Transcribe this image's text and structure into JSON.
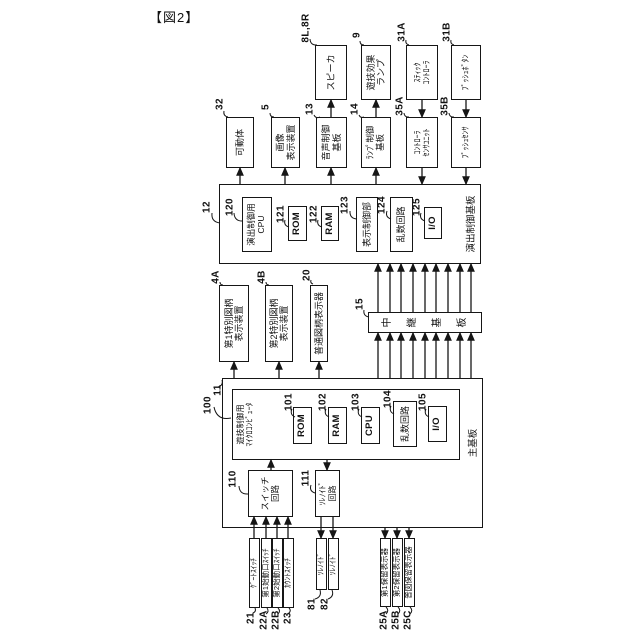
{
  "figure_label": "【図2】",
  "colors": {
    "line": "#161616",
    "background": "#ffffff"
  },
  "diagram": {
    "boxes": [
      {
        "name": "speaker",
        "x": 540,
        "y": 315,
        "w": 55,
        "h": 32,
        "lines": [
          "スピーカ"
        ]
      },
      {
        "name": "game-effect-lamp",
        "x": 540,
        "y": 361,
        "w": 55,
        "h": 30,
        "lines": [
          "遊技効果",
          "ランプ"
        ]
      },
      {
        "name": "stick-controller",
        "x": 540,
        "y": 406,
        "w": 55,
        "h": 32,
        "lines": [
          "ｽﾃｨｯｸ",
          "ｺﾝﾄﾛｰﾗ"
        ],
        "fs": 8
      },
      {
        "name": "push-button",
        "x": 540,
        "y": 451,
        "w": 55,
        "h": 30,
        "lines": [
          "ﾌﾟｯｼｭﾎﾞﾀﾝ"
        ],
        "fs": 8
      },
      {
        "name": "movable-body",
        "x": 472,
        "y": 226,
        "w": 51,
        "h": 28,
        "lines": [
          "可動体"
        ]
      },
      {
        "name": "image-display-device",
        "x": 472,
        "y": 271,
        "w": 51,
        "h": 29,
        "lines": [
          "画像",
          "表示装置"
        ]
      },
      {
        "name": "audio-control-board",
        "x": 472,
        "y": 316,
        "w": 51,
        "h": 31,
        "lines": [
          "音声制御",
          "基板"
        ]
      },
      {
        "name": "lamp-control-board",
        "x": 472,
        "y": 361,
        "w": 51,
        "h": 30,
        "lines": [
          "ﾗﾝﾌﾟ制御",
          "基板"
        ],
        "fs": 8.5
      },
      {
        "name": "controller-sensor-unit",
        "x": 472,
        "y": 406,
        "w": 51,
        "h": 32,
        "lines": [
          "ｺﾝﾄﾛｰﾗ",
          "ｾﾝｻﾕﾆｯﾄ"
        ],
        "fs": 8
      },
      {
        "name": "push-sensor",
        "x": 472,
        "y": 451,
        "w": 51,
        "h": 30,
        "lines": [
          "ﾌﾟｯｼｭｾﾝｻ"
        ],
        "fs": 8
      },
      {
        "name": "effect-control-board",
        "x": 376,
        "y": 219,
        "w": 80,
        "h": 262,
        "lines": [],
        "frame": true
      },
      {
        "name": "effect-cpu",
        "x": 388,
        "y": 242,
        "w": 55,
        "h": 30,
        "lines": [
          "演出制御用",
          "CPU"
        ],
        "fs": 8.5
      },
      {
        "name": "effect-rom",
        "x": 399,
        "y": 288,
        "w": 35,
        "h": 19,
        "lines": [
          "ROM"
        ],
        "bold": true
      },
      {
        "name": "effect-ram",
        "x": 399,
        "y": 321,
        "w": 35,
        "h": 18,
        "lines": [
          "RAM"
        ],
        "bold": true
      },
      {
        "name": "display-control-unit",
        "x": 388,
        "y": 356,
        "w": 55,
        "h": 22,
        "lines": [
          "表示制御部"
        ]
      },
      {
        "name": "effect-random-circuit",
        "x": 388,
        "y": 390,
        "w": 55,
        "h": 23,
        "lines": [
          "乱数回路"
        ]
      },
      {
        "name": "effect-io",
        "x": 401,
        "y": 424,
        "w": 32,
        "h": 18,
        "lines": [
          "I/O"
        ],
        "bold": true
      },
      {
        "name": "first-special-symbol-display",
        "x": 278,
        "y": 219,
        "w": 77,
        "h": 30,
        "lines": [
          "第1特別図柄",
          "表示装置"
        ]
      },
      {
        "name": "second-special-symbol-display",
        "x": 278,
        "y": 265,
        "w": 77,
        "h": 28,
        "lines": [
          "第2特別図柄",
          "表示装置"
        ]
      },
      {
        "name": "normal-symbol-display",
        "x": 278,
        "y": 310,
        "w": 77,
        "h": 18,
        "lines": [
          "普通図柄表示器"
        ]
      },
      {
        "name": "relay-board",
        "x": 307,
        "y": 368,
        "w": 21,
        "h": 114,
        "lines": [
          "中継基板"
        ],
        "vertical": true
      },
      {
        "name": "main-board",
        "x": 112,
        "y": 222,
        "w": 150,
        "h": 261,
        "lines": [],
        "frame": true
      },
      {
        "name": "game-control-microcomputer",
        "x": 180,
        "y": 232,
        "w": 71,
        "h": 228,
        "lines": [
          "遊技制御用",
          "ﾏｲｸﾛｺﾝﾋﾟｭｰﾀ"
        ],
        "labelTop": true,
        "fs": 8
      },
      {
        "name": "main-rom",
        "x": 196,
        "y": 293,
        "w": 37,
        "h": 19,
        "lines": [
          "ROM"
        ],
        "bold": true
      },
      {
        "name": "main-ram",
        "x": 196,
        "y": 328,
        "w": 37,
        "h": 19,
        "lines": [
          "RAM"
        ],
        "bold": true
      },
      {
        "name": "main-cpu",
        "x": 196,
        "y": 361,
        "w": 37,
        "h": 19,
        "lines": [
          "CPU"
        ],
        "bold": true
      },
      {
        "name": "main-random-circuit",
        "x": 193,
        "y": 393,
        "w": 46,
        "h": 24,
        "lines": [
          "乱数回路"
        ]
      },
      {
        "name": "main-io",
        "x": 198,
        "y": 428,
        "w": 36,
        "h": 19,
        "lines": [
          "I/O"
        ],
        "bold": true
      },
      {
        "name": "switch-circuit",
        "x": 123,
        "y": 248,
        "w": 47,
        "h": 45,
        "lines": [
          "スイッチ",
          "回路"
        ],
        "fs": 8.5
      },
      {
        "name": "solenoid-circuit",
        "x": 123,
        "y": 315,
        "w": 47,
        "h": 25,
        "lines": [
          "ｿﾚﾉｲﾄﾞ",
          "回路"
        ],
        "fs": 8
      },
      {
        "name": "gate-switch",
        "x": 32,
        "y": 249,
        "w": 70,
        "h": 11,
        "lines": [
          "ｹﾞｰﾄｽｲｯﾁ"
        ],
        "fs": 7.5
      },
      {
        "name": "first-start-switch",
        "x": 32,
        "y": 261,
        "w": 70,
        "h": 11,
        "lines": [
          "第1始動口ｽｲｯﾁ"
        ],
        "fs": 7.5
      },
      {
        "name": "second-start-switch",
        "x": 32,
        "y": 272,
        "w": 70,
        "h": 11,
        "lines": [
          "第2始動口ｽｲｯﾁ"
        ],
        "fs": 7.5
      },
      {
        "name": "count-switch",
        "x": 32,
        "y": 283,
        "w": 70,
        "h": 11,
        "lines": [
          "ｶｳﾝﾄｽｲｯﾁ"
        ],
        "fs": 7.5
      },
      {
        "name": "solenoid-81",
        "x": 50,
        "y": 316,
        "w": 52,
        "h": 11,
        "lines": [
          "ｿﾚﾉｲﾄﾞ"
        ],
        "fs": 7.5
      },
      {
        "name": "solenoid-82",
        "x": 50,
        "y": 328,
        "w": 52,
        "h": 11,
        "lines": [
          "ｿﾚﾉｲﾄﾞ"
        ],
        "fs": 7.5
      },
      {
        "name": "first-hold-display",
        "x": 33,
        "y": 380,
        "w": 69,
        "h": 11,
        "lines": [
          "第1保留表示器"
        ],
        "fs": 7.5
      },
      {
        "name": "second-hold-display",
        "x": 33,
        "y": 392,
        "w": 69,
        "h": 11,
        "lines": [
          "第2保留表示器"
        ],
        "fs": 7.5
      },
      {
        "name": "normal-symbol-hold-display",
        "x": 33,
        "y": 404,
        "w": 69,
        "h": 11,
        "lines": [
          "普図保留表示器"
        ],
        "fs": 7.5
      }
    ],
    "board_labels": [
      {
        "name": "effect-control-board-label",
        "x": 416,
        "y": 470,
        "text": "演出制御基板"
      },
      {
        "name": "main-board-label",
        "x": 197,
        "y": 472,
        "text": "主基板"
      }
    ],
    "refs": [
      {
        "text": "8L,8R",
        "x": 612,
        "y": 306,
        "lead": [
          601,
          310,
          595,
          317
        ]
      },
      {
        "text": "9",
        "x": 605,
        "y": 357,
        "lead": [
          599,
          360,
          595,
          364
        ]
      },
      {
        "text": "31A",
        "x": 608,
        "y": 402,
        "lead": [
          600,
          406,
          595,
          409
        ]
      },
      {
        "text": "31B",
        "x": 608,
        "y": 447,
        "lead": [
          600,
          451,
          595,
          454
        ]
      },
      {
        "text": "32",
        "x": 536,
        "y": 220,
        "lead": [
          529,
          224,
          523,
          228
        ]
      },
      {
        "text": "5",
        "x": 533,
        "y": 266,
        "lead": [
          527,
          270,
          523,
          274
        ]
      },
      {
        "text": "13",
        "x": 531,
        "y": 310,
        "lead": [
          525,
          314,
          523,
          320
        ]
      },
      {
        "text": "14",
        "x": 531,
        "y": 355,
        "lead": [
          525,
          359,
          523,
          364
        ]
      },
      {
        "text": "35A",
        "x": 534,
        "y": 400,
        "lead": [
          527,
          404,
          523,
          409
        ]
      },
      {
        "text": "35B",
        "x": 534,
        "y": 445,
        "lead": [
          527,
          449,
          523,
          454
        ]
      },
      {
        "text": "12",
        "x": 433,
        "y": 207,
        "lead": [
          427,
          212,
          417,
          220
        ]
      },
      {
        "text": "120",
        "x": 433,
        "y": 230,
        "lead": [
          427,
          234,
          419,
          243
        ]
      },
      {
        "text": "121",
        "x": 426,
        "y": 281,
        "lead": [
          420,
          285,
          413,
          289
        ]
      },
      {
        "text": "122",
        "x": 426,
        "y": 314,
        "lead": [
          420,
          318,
          413,
          322
        ]
      },
      {
        "text": "123",
        "x": 435,
        "y": 345,
        "lead": [
          429,
          350,
          421,
          357
        ]
      },
      {
        "text": "124",
        "x": 435,
        "y": 382,
        "lead": [
          429,
          387,
          421,
          391
        ]
      },
      {
        "text": "125",
        "x": 433,
        "y": 417,
        "lead": [
          427,
          421,
          419,
          425
        ]
      },
      {
        "text": "4A",
        "x": 363,
        "y": 216,
        "lead": [
          358,
          220,
          355,
          223
        ]
      },
      {
        "text": "4B",
        "x": 363,
        "y": 262,
        "lead": [
          358,
          266,
          355,
          269
        ]
      },
      {
        "text": "20",
        "x": 365,
        "y": 307,
        "lead": [
          360,
          311,
          356,
          313
        ]
      },
      {
        "text": "15",
        "x": 336,
        "y": 360,
        "lead": [
          330,
          364,
          323,
          369
        ]
      },
      {
        "text": "100",
        "x": 235,
        "y": 208,
        "lead": [
          233,
          214,
          222,
          231
        ]
      },
      {
        "text": "11",
        "x": 250,
        "y": 218,
        "lead": [
          253,
          218,
          260,
          222
        ]
      },
      {
        "text": "110",
        "x": 161,
        "y": 233,
        "lead": [
          154,
          239,
          146,
          248
        ]
      },
      {
        "text": "111",
        "x": 162,
        "y": 306,
        "lead": [
          155,
          311,
          147,
          315
        ]
      },
      {
        "text": "101",
        "x": 238,
        "y": 289,
        "lead": [
          231,
          292,
          223,
          295
        ]
      },
      {
        "text": "102",
        "x": 238,
        "y": 323,
        "lead": [
          231,
          326,
          223,
          329
        ]
      },
      {
        "text": "103",
        "x": 238,
        "y": 356,
        "lead": [
          231,
          359,
          223,
          362
        ]
      },
      {
        "text": "104",
        "x": 241,
        "y": 388,
        "lead": [
          234,
          391,
          226,
          394
        ]
      },
      {
        "text": "105",
        "x": 238,
        "y": 423,
        "lead": [
          231,
          426,
          223,
          429
        ]
      },
      {
        "text": "21",
        "x": 22,
        "y": 251,
        "lead": [
          27,
          253,
          32,
          255
        ]
      },
      {
        "text": "22A",
        "x": 20,
        "y": 264,
        "lead": [
          26,
          266,
          32,
          267
        ]
      },
      {
        "text": "22B",
        "x": 20,
        "y": 276,
        "lead": [
          26,
          278,
          32,
          278
        ]
      },
      {
        "text": "23",
        "x": 22,
        "y": 288,
        "lead": [
          27,
          289,
          32,
          289
        ]
      },
      {
        "text": "81",
        "x": 36,
        "y": 312,
        "lead": [
          41,
          315,
          50,
          320
        ]
      },
      {
        "text": "82",
        "x": 36,
        "y": 325,
        "lead": [
          41,
          328,
          50,
          332
        ]
      },
      {
        "text": "25A",
        "x": 20,
        "y": 384,
        "lead": [
          26,
          386,
          33,
          386
        ]
      },
      {
        "text": "25B",
        "x": 20,
        "y": 396,
        "lead": [
          26,
          398,
          33,
          398
        ]
      },
      {
        "text": "25C",
        "x": 20,
        "y": 408,
        "lead": [
          26,
          410,
          33,
          410
        ]
      }
    ],
    "arrows": [
      [
        456,
        240,
        472,
        240
      ],
      [
        456,
        285,
        472,
        285
      ],
      [
        456,
        331,
        472,
        331
      ],
      [
        456,
        376,
        472,
        376
      ],
      [
        523,
        331,
        540,
        331
      ],
      [
        523,
        376,
        540,
        376
      ],
      [
        540,
        422,
        523,
        422
      ],
      [
        472,
        422,
        456,
        422
      ],
      [
        540,
        466,
        523,
        466
      ],
      [
        472,
        466,
        456,
        466
      ],
      [
        262,
        234,
        278,
        234
      ],
      [
        262,
        279,
        278,
        279
      ],
      [
        262,
        319,
        278,
        319
      ],
      [
        262,
        378,
        307,
        378
      ],
      [
        328,
        378,
        376,
        378
      ],
      [
        262,
        390,
        307,
        390
      ],
      [
        328,
        390,
        376,
        390
      ],
      [
        262,
        401,
        307,
        401
      ],
      [
        328,
        401,
        376,
        401
      ],
      [
        262,
        413,
        307,
        413
      ],
      [
        328,
        413,
        376,
        413
      ],
      [
        262,
        425,
        307,
        425
      ],
      [
        328,
        425,
        376,
        425
      ],
      [
        262,
        436,
        307,
        436
      ],
      [
        328,
        436,
        376,
        436
      ],
      [
        262,
        448,
        307,
        448
      ],
      [
        328,
        448,
        376,
        448
      ],
      [
        262,
        460,
        307,
        460
      ],
      [
        328,
        460,
        376,
        460
      ],
      [
        262,
        471,
        307,
        471
      ],
      [
        328,
        471,
        376,
        471
      ],
      [
        170,
        271,
        180,
        271
      ],
      [
        180,
        327,
        170,
        327
      ],
      [
        102,
        254,
        123,
        254
      ],
      [
        102,
        266,
        123,
        266
      ],
      [
        102,
        277,
        123,
        277
      ],
      [
        102,
        288,
        123,
        288
      ],
      [
        123,
        321,
        102,
        321
      ],
      [
        123,
        333,
        102,
        333
      ],
      [
        112,
        385,
        102,
        385
      ],
      [
        112,
        397,
        102,
        397
      ],
      [
        112,
        409,
        102,
        409
      ]
    ]
  }
}
